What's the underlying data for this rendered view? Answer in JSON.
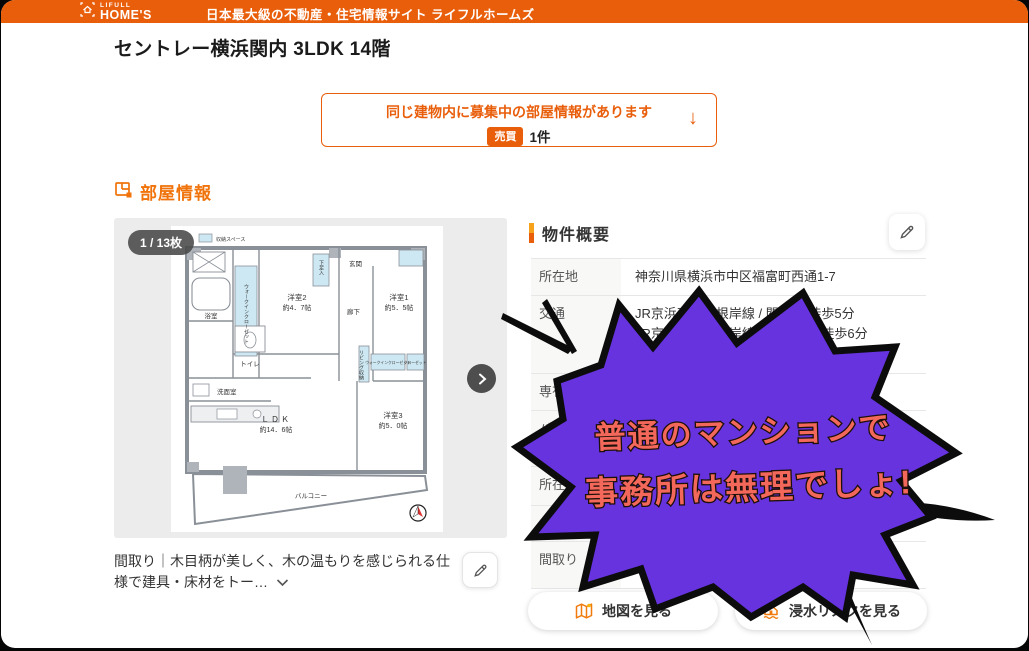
{
  "header": {
    "logo_small": "LIFULL",
    "logo_main": "HOME'S",
    "tagline": "日本最大級の不動産・住宅情報サイト ライフルホームズ"
  },
  "page": {
    "title": "セントレー横浜関内 3LDK 14階"
  },
  "notice": {
    "line1": "同じ建物内に募集中の部屋情報があります",
    "badge": "売買",
    "count": "1件",
    "arrow": "↓"
  },
  "room_section": {
    "title": "部屋情報",
    "photo_counter": "1 / 13枚",
    "caption": "間取り｜木目柄が美しく、木の温もりを感じられる仕様で建具・床材をトー…"
  },
  "floorplan": {
    "legend": "収納スペース",
    "bath": "浴室",
    "wic_vertical": "ウォークインクローゼット",
    "room2": "洋室2",
    "room2_size": "約4．7帖",
    "shoe": "下足入",
    "entrance": "玄関",
    "hall": "廊下",
    "room1": "洋室1",
    "room1_size": "約5．5帖",
    "toilet": "トイレ",
    "wash": "洗面室",
    "living_storage": "リビング収納",
    "wic2": "ウォークインクローゼット",
    "closet": "クローゼット",
    "ldk": "ＬＤＫ",
    "ldk_size": "約14．6帖",
    "room3": "洋室3",
    "room3_size": "約5．0帖",
    "balcony": "バルコニー"
  },
  "summary": {
    "title": "物件概要",
    "row_address_label": "所在地",
    "row_address_value": "神奈川県横浜市中区福富町西通1-7",
    "row_transit_label": "交通",
    "row_transit_line1": "JR京浜東北・根岸線 / 関内駅 徒歩5分",
    "row_transit_line2": "JR京浜東北・根岸線 / 桜木町駅 徒歩6分",
    "row_transit_link": "見る",
    "row_area_label": "専有面積",
    "row_area_value": "",
    "row_balcony_label": "バルコニー面積",
    "row_balcony_value": "",
    "row_floor_label": "所在階",
    "row_floor_value": "",
    "row_light_label": "主要採光面",
    "row_light_value": "",
    "row_layout_label": "間取り",
    "row_layout_value": "3LDK（LDK14.6帖（リビングダイ"
  },
  "buttons": {
    "map": "地図を見る",
    "flood": "浸水リスクを見る"
  },
  "bubble": {
    "line1": "普通のマンションで",
    "line2": "事務所は無理でしょ!"
  },
  "colors": {
    "accent_orange": "#E95E0B",
    "bubble_purple": "#6633DF",
    "bubble_text": "#F4685C",
    "link_blue": "#1A69C7"
  }
}
